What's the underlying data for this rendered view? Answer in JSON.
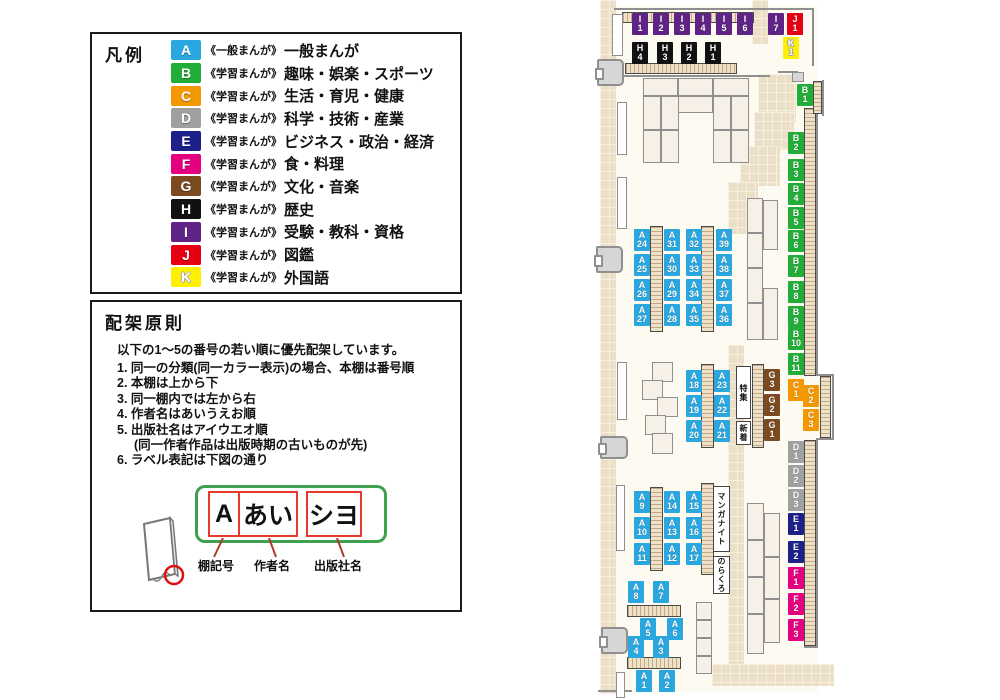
{
  "legend": {
    "title": "凡例",
    "items": [
      {
        "code": "A",
        "color": "#2ba7df",
        "series": "《一般まんが》",
        "category": "一般まんが"
      },
      {
        "code": "B",
        "color": "#22ac38",
        "series": "《学習まんが》",
        "category": "趣味・娯楽・スポーツ"
      },
      {
        "code": "C",
        "color": "#f39800",
        "series": "《学習まんが》",
        "category": "生活・育児・健康"
      },
      {
        "code": "D",
        "color": "#9fa0a0",
        "series": "《学習まんが》",
        "category": "科学・技術・産業"
      },
      {
        "code": "E",
        "color": "#1d2088",
        "series": "《学習まんが》",
        "category": "ビジネス・政治・経済"
      },
      {
        "code": "F",
        "color": "#e4007f",
        "series": "《学習まんが》",
        "category": "食・料理"
      },
      {
        "code": "G",
        "color": "#7b4a21",
        "series": "《学習まんが》",
        "category": "文化・音楽"
      },
      {
        "code": "H",
        "color": "#111111",
        "series": "《学習まんが》",
        "category": "歴史"
      },
      {
        "code": "I",
        "color": "#5f2385",
        "series": "《学習まんが》",
        "category": "受験・教科・資格"
      },
      {
        "code": "J",
        "color": "#e60012",
        "series": "《学習まんが》",
        "category": "図鑑"
      },
      {
        "code": "K",
        "color": "#ffef00",
        "series": "《学習まんが》",
        "category": "外国語"
      }
    ]
  },
  "principles": {
    "title": "配架原則",
    "intro": "以下の1〜5の番号の若い順に優先配架しています。",
    "rules": [
      {
        "num": "1.",
        "text": "同一の分類(同一カラー表示)の場合、本棚は番号順"
      },
      {
        "num": "2.",
        "text": "本棚は上から下"
      },
      {
        "num": "3.",
        "text": "同一棚内では左から右"
      },
      {
        "num": "4.",
        "text": "作者名はあいうえお順"
      },
      {
        "num": "5.",
        "text": "出版社名はアイウエオ順",
        "sub": "(同一作者作品は出版時期の古いものが先)"
      },
      {
        "num": "6.",
        "text": "ラベル表記は下図の通り"
      }
    ],
    "diagram": {
      "shelf_code": "A",
      "author": "あい",
      "publisher": "シヨ",
      "captions": [
        "棚記号",
        "作者名",
        "出版社名"
      ]
    }
  },
  "map": {
    "category_colors": {
      "A": "#2ba7df",
      "B": "#22ac38",
      "C": "#f39800",
      "D": "#9fa0a0",
      "E": "#1d2088",
      "F": "#e4007f",
      "G": "#7b4a21",
      "H": "#111111",
      "I": "#5f2385",
      "J": "#e60012",
      "K": "#ffef00"
    },
    "shelf_labels": [
      {
        "code": "I1",
        "x": 632,
        "y": 13
      },
      {
        "code": "I2",
        "x": 653,
        "y": 13
      },
      {
        "code": "I3",
        "x": 674,
        "y": 13
      },
      {
        "code": "I4",
        "x": 695,
        "y": 13
      },
      {
        "code": "I5",
        "x": 716,
        "y": 13
      },
      {
        "code": "I6",
        "x": 737,
        "y": 13
      },
      {
        "code": "I7",
        "x": 768,
        "y": 13
      },
      {
        "code": "J1",
        "x": 787,
        "y": 13
      },
      {
        "code": "K1",
        "x": 783,
        "y": 37
      },
      {
        "code": "H4",
        "x": 632,
        "y": 42
      },
      {
        "code": "H3",
        "x": 657,
        "y": 42
      },
      {
        "code": "H2",
        "x": 681,
        "y": 42
      },
      {
        "code": "H1",
        "x": 705,
        "y": 42
      },
      {
        "code": "B1",
        "x": 797,
        "y": 84
      },
      {
        "code": "B2",
        "x": 788,
        "y": 132
      },
      {
        "code": "B3",
        "x": 788,
        "y": 159
      },
      {
        "code": "B4",
        "x": 788,
        "y": 183
      },
      {
        "code": "B5",
        "x": 788,
        "y": 207
      },
      {
        "code": "B6",
        "x": 788,
        "y": 230
      },
      {
        "code": "B7",
        "x": 788,
        "y": 255
      },
      {
        "code": "B8",
        "x": 788,
        "y": 281
      },
      {
        "code": "B9",
        "x": 788,
        "y": 306
      },
      {
        "code": "B10",
        "x": 788,
        "y": 328
      },
      {
        "code": "B11",
        "x": 788,
        "y": 353
      },
      {
        "code": "C1",
        "x": 788,
        "y": 379
      },
      {
        "code": "C2",
        "x": 803,
        "y": 385
      },
      {
        "code": "C3",
        "x": 803,
        "y": 409
      },
      {
        "code": "G3",
        "x": 764,
        "y": 369
      },
      {
        "code": "G2",
        "x": 764,
        "y": 394
      },
      {
        "code": "G1",
        "x": 764,
        "y": 419
      },
      {
        "code": "D1",
        "x": 788,
        "y": 441
      },
      {
        "code": "D2",
        "x": 788,
        "y": 465
      },
      {
        "code": "D3",
        "x": 788,
        "y": 489
      },
      {
        "code": "E1",
        "x": 788,
        "y": 513
      },
      {
        "code": "E2",
        "x": 788,
        "y": 541
      },
      {
        "code": "F1",
        "x": 788,
        "y": 567
      },
      {
        "code": "F2",
        "x": 788,
        "y": 593
      },
      {
        "code": "F3",
        "x": 788,
        "y": 619
      },
      {
        "code": "A24",
        "x": 634,
        "y": 229
      },
      {
        "code": "A25",
        "x": 634,
        "y": 254
      },
      {
        "code": "A26",
        "x": 634,
        "y": 279
      },
      {
        "code": "A27",
        "x": 634,
        "y": 304
      },
      {
        "code": "A31",
        "x": 664,
        "y": 229
      },
      {
        "code": "A30",
        "x": 664,
        "y": 254
      },
      {
        "code": "A29",
        "x": 664,
        "y": 279
      },
      {
        "code": "A28",
        "x": 664,
        "y": 304
      },
      {
        "code": "A32",
        "x": 686,
        "y": 229
      },
      {
        "code": "A33",
        "x": 686,
        "y": 254
      },
      {
        "code": "A34",
        "x": 686,
        "y": 279
      },
      {
        "code": "A35",
        "x": 686,
        "y": 304
      },
      {
        "code": "A39",
        "x": 716,
        "y": 229
      },
      {
        "code": "A38",
        "x": 716,
        "y": 254
      },
      {
        "code": "A37",
        "x": 716,
        "y": 279
      },
      {
        "code": "A36",
        "x": 716,
        "y": 304
      },
      {
        "code": "A18",
        "x": 686,
        "y": 370
      },
      {
        "code": "A19",
        "x": 686,
        "y": 395
      },
      {
        "code": "A20",
        "x": 686,
        "y": 420
      },
      {
        "code": "A23",
        "x": 714,
        "y": 370
      },
      {
        "code": "A22",
        "x": 714,
        "y": 395
      },
      {
        "code": "A21",
        "x": 714,
        "y": 420
      },
      {
        "code": "A9",
        "x": 634,
        "y": 491
      },
      {
        "code": "A10",
        "x": 634,
        "y": 517
      },
      {
        "code": "A11",
        "x": 634,
        "y": 543
      },
      {
        "code": "A14",
        "x": 664,
        "y": 491
      },
      {
        "code": "A13",
        "x": 664,
        "y": 517
      },
      {
        "code": "A12",
        "x": 664,
        "y": 543
      },
      {
        "code": "A15",
        "x": 686,
        "y": 491
      },
      {
        "code": "A16",
        "x": 686,
        "y": 517
      },
      {
        "code": "A17",
        "x": 686,
        "y": 543
      },
      {
        "code": "A8",
        "x": 628,
        "y": 581
      },
      {
        "code": "A7",
        "x": 653,
        "y": 581
      },
      {
        "code": "A5",
        "x": 640,
        "y": 618
      },
      {
        "code": "A6",
        "x": 667,
        "y": 618
      },
      {
        "code": "A4",
        "x": 628,
        "y": 636
      },
      {
        "code": "A3",
        "x": 653,
        "y": 636
      },
      {
        "code": "A1",
        "x": 636,
        "y": 670
      },
      {
        "code": "A2",
        "x": 659,
        "y": 670
      }
    ],
    "text_boxes": [
      {
        "id": "tokushu",
        "text": "特集",
        "x": 736,
        "y": 366,
        "w": 15,
        "h": 53
      },
      {
        "id": "shinchaku",
        "text": "新着",
        "x": 736,
        "y": 421,
        "w": 15,
        "h": 24
      },
      {
        "id": "manga-night",
        "text": "マンガナイト",
        "x": 713,
        "y": 486,
        "w": 17,
        "h": 66
      },
      {
        "id": "norakuro",
        "text": "のらくろ",
        "x": 713,
        "y": 556,
        "w": 17,
        "h": 38
      }
    ]
  }
}
